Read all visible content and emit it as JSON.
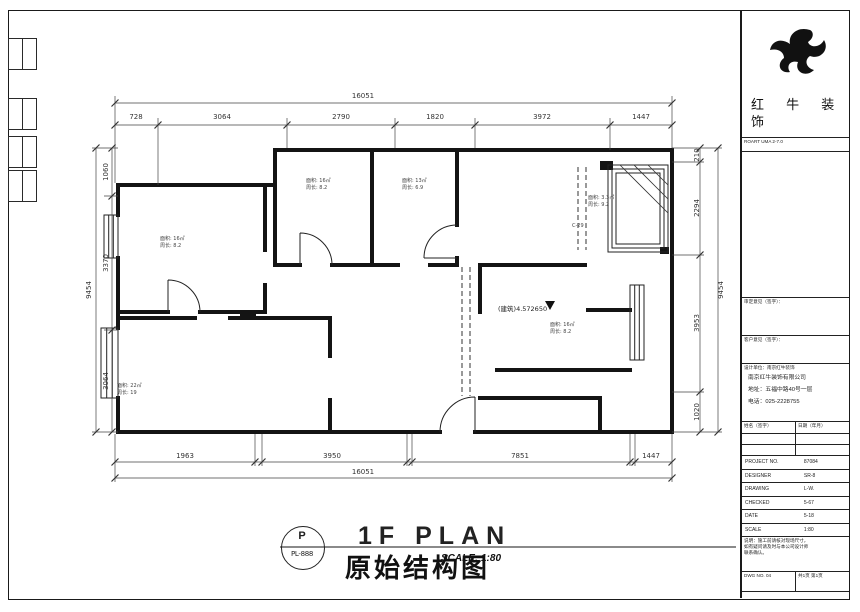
{
  "titlebar": {
    "plan_code_letter": "P",
    "plan_code": "PL-888",
    "title_en": "1F PLAN",
    "title_cn": "原始结构图",
    "scale": "SCALE: 1:80"
  },
  "dimensions": {
    "top_overall": "16051",
    "top_segments": [
      "728",
      "3064",
      "2790",
      "1820",
      "3972",
      "1447"
    ],
    "bottom_segments": [
      "1963",
      "3950",
      "7851",
      "1447"
    ],
    "bottom_overall": "16051",
    "left_overall": "9454",
    "left_segments": [
      "1060",
      "3370",
      "3064"
    ],
    "right_overall": "9454",
    "right_segments": [
      "210",
      "2294",
      "3953",
      "1020"
    ]
  },
  "rooms": [
    {
      "area": "面积: 16㎡",
      "perimeter": "周长: 8.2"
    },
    {
      "area": "面积: 16㎡",
      "perimeter": "周长: 8.2"
    },
    {
      "area": "面积: 13㎡",
      "perimeter": "周长: 6.9"
    },
    {
      "area": "面积: 3.3㎡",
      "perimeter": "周长: 9.2"
    },
    {
      "area": "面积: 16㎡",
      "perimeter": "周长: 8.2"
    },
    {
      "area": "面积: 22㎡",
      "perimeter": "周长: 19"
    }
  ],
  "annotations": {
    "level": "(建筑)4.572650",
    "window_tag": "C-29"
  },
  "title_block": {
    "brand_line1": "红 牛 装",
    "brand_line2": "饰",
    "brand_sub": "ROART UMA  2-7.0",
    "approval_header": "审定意见（签字）：",
    "client_header": "客户意见（签字）：",
    "company_header": "设计单位：南京红牛装饰",
    "company_name": "南京红牛装饰有限公司",
    "company_address": "地址：五福中路40号一层",
    "company_phone": "电话：025-2228755",
    "sign_label": "姓名（签字）",
    "date_label": "日期（年月）",
    "fields": [
      {
        "label": "PROJECT NO.",
        "value": "87084"
      },
      {
        "label": "DESIGNER",
        "value": "SR-8"
      },
      {
        "label": "DRAWING",
        "value": "L-W."
      },
      {
        "label": "CHECKED",
        "value": "5-67"
      },
      {
        "label": "DATE",
        "value": "5-18"
      },
      {
        "label": "SCALE",
        "value": "1:80"
      }
    ],
    "notes_line1": "说明：施工前请核对现场尺寸，",
    "notes_line2": "如有疑问请及时与本公司设计师",
    "notes_line3": "联系确认。",
    "dwg_label": "DWG NO. 04",
    "page_label": "共1页 第1页"
  }
}
